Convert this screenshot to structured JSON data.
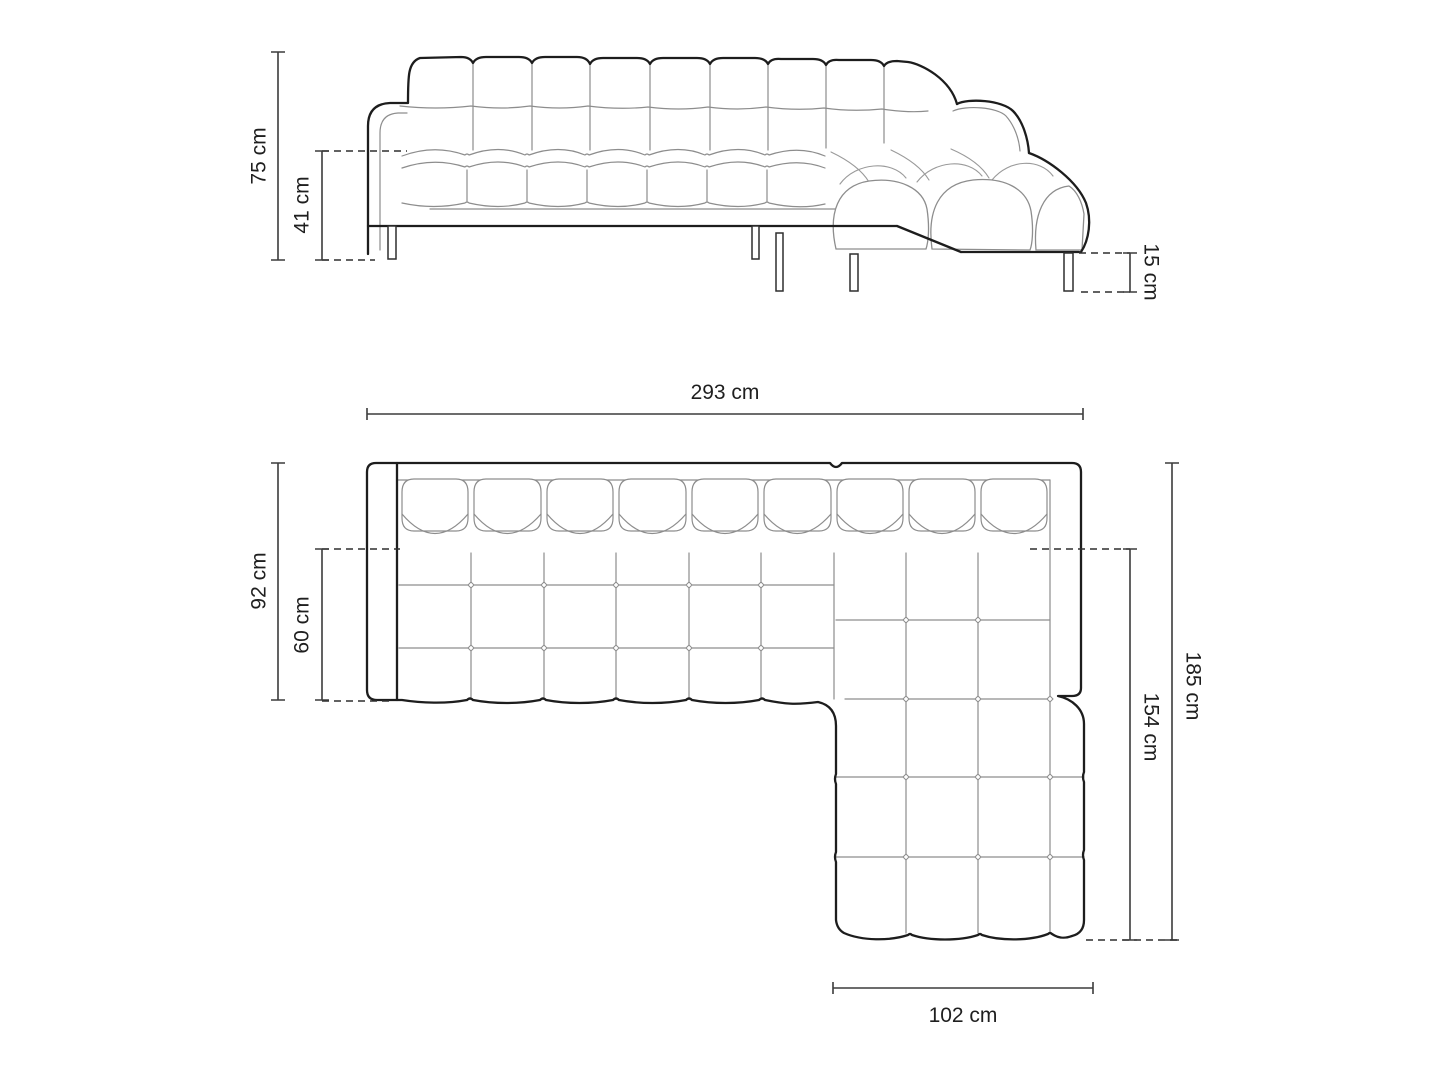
{
  "page": {
    "background": "#ffffff",
    "description": "technical dimension drawing of a left-corner tufted sofa, front elevation and top plan view"
  },
  "drawing": {
    "outline_color": "#1d1d1d",
    "detail_line_color": "#8d8d8d",
    "dimension_line_color": "#3c3c3c",
    "dashed_line_color": "#2e2e2e",
    "text_color": "#1f1f1f",
    "unit": "cm"
  },
  "views": {
    "front_elevation": {
      "name": "front view"
    },
    "top_plan": {
      "name": "top view"
    }
  },
  "dimensions": {
    "total_height": {
      "value": 75,
      "unit": "cm",
      "label": "75 cm"
    },
    "seat_height": {
      "value": 41,
      "unit": "cm",
      "label": "41 cm"
    },
    "leg_height": {
      "value": 15,
      "unit": "cm",
      "label": "15 cm"
    },
    "total_width": {
      "value": 293,
      "unit": "cm",
      "label": "293 cm"
    },
    "total_depth": {
      "value": 92,
      "unit": "cm",
      "label": "92 cm"
    },
    "seat_depth": {
      "value": 60,
      "unit": "cm",
      "label": "60 cm"
    },
    "chaise_total_length": {
      "value": 185,
      "unit": "cm",
      "label": "185 cm"
    },
    "chaise_inner_length": {
      "value": 154,
      "unit": "cm",
      "label": "154 cm"
    },
    "chaise_width": {
      "value": 102,
      "unit": "cm",
      "label": "102 cm"
    }
  }
}
